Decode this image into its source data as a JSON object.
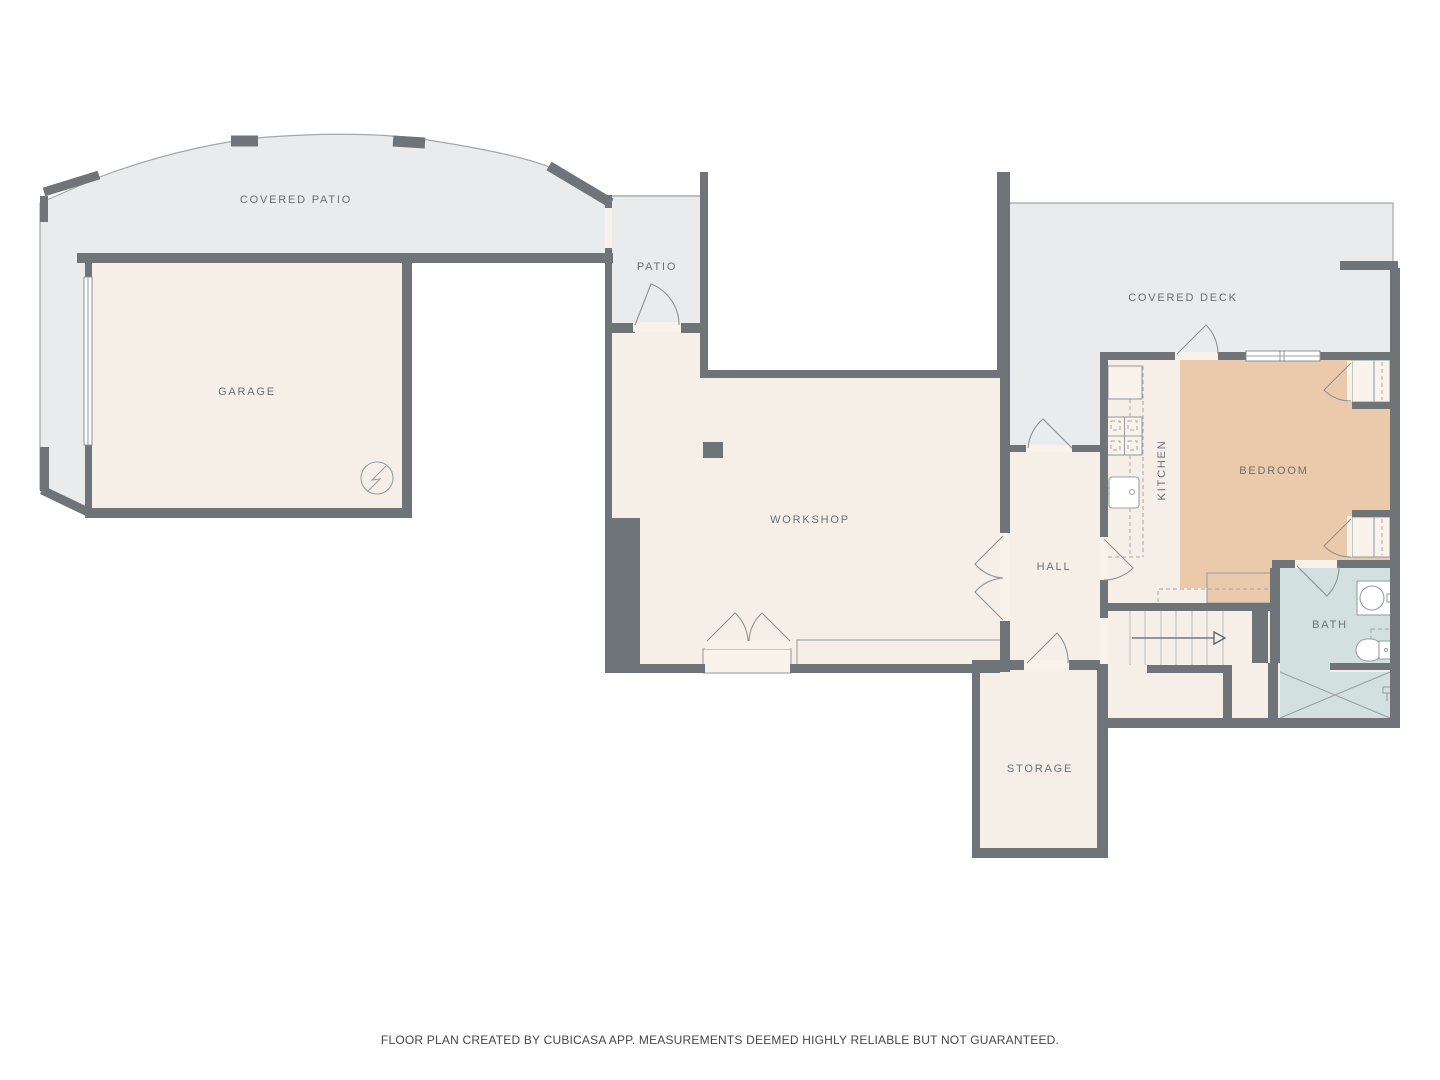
{
  "plan": {
    "rooms": {
      "covered_patio": {
        "label": "COVERED PATIO"
      },
      "garage": {
        "label": "GARAGE"
      },
      "patio": {
        "label": "PATIO"
      },
      "workshop": {
        "label": "WORKSHOP"
      },
      "covered_deck": {
        "label": "COVERED DECK"
      },
      "kitchen": {
        "label": "KITCHEN"
      },
      "bedroom": {
        "label": "BEDROOM"
      },
      "hall": {
        "label": "HALL"
      },
      "bath": {
        "label": "BATH"
      },
      "storage": {
        "label": "STORAGE"
      }
    },
    "colors": {
      "outdoor_floor": "#e9ebec",
      "indoor_floor": "#f6efe8",
      "bedroom_floor": "#ebc9ab",
      "bath_floor": "#d2e1df",
      "wall": "#6f7478",
      "label_text": "#6b7075",
      "footer_text": "#43474a"
    }
  },
  "footer": {
    "disclaimer": "FLOOR PLAN CREATED BY CUBICASA APP. MEASUREMENTS DEEMED HIGHLY RELIABLE BUT NOT GUARANTEED."
  }
}
